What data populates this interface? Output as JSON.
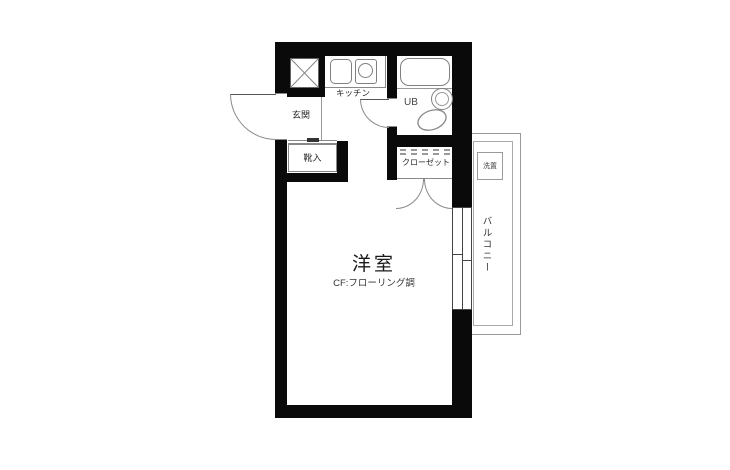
{
  "labels": {
    "main_room": "洋室",
    "main_room_floor": "CF:フローリング調",
    "entrance": "玄関",
    "shoe_cabinet": "靴入",
    "kitchen": "キッチン",
    "unit_bath": "UB",
    "closet": "クローゼット",
    "balcony": "バルコニー",
    "laundry_place": "洗置"
  },
  "colors": {
    "wall": "#0a0a0a",
    "fixture_line": "#888888",
    "text": "#222222",
    "background": "#ffffff"
  }
}
